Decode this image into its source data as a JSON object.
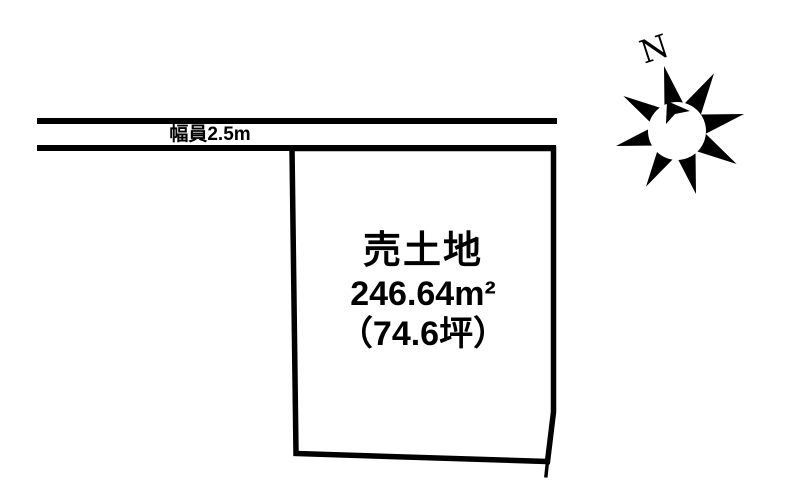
{
  "diagram": {
    "background_color": "#ffffff",
    "line_color": "#000000",
    "road": {
      "width_label": "幅員2.5m"
    },
    "plot": {
      "sale_label": "売土地",
      "area_sqm": "246.64m²",
      "area_tsubo": "（74.6坪）"
    },
    "compass": {
      "north_label": "N"
    }
  }
}
